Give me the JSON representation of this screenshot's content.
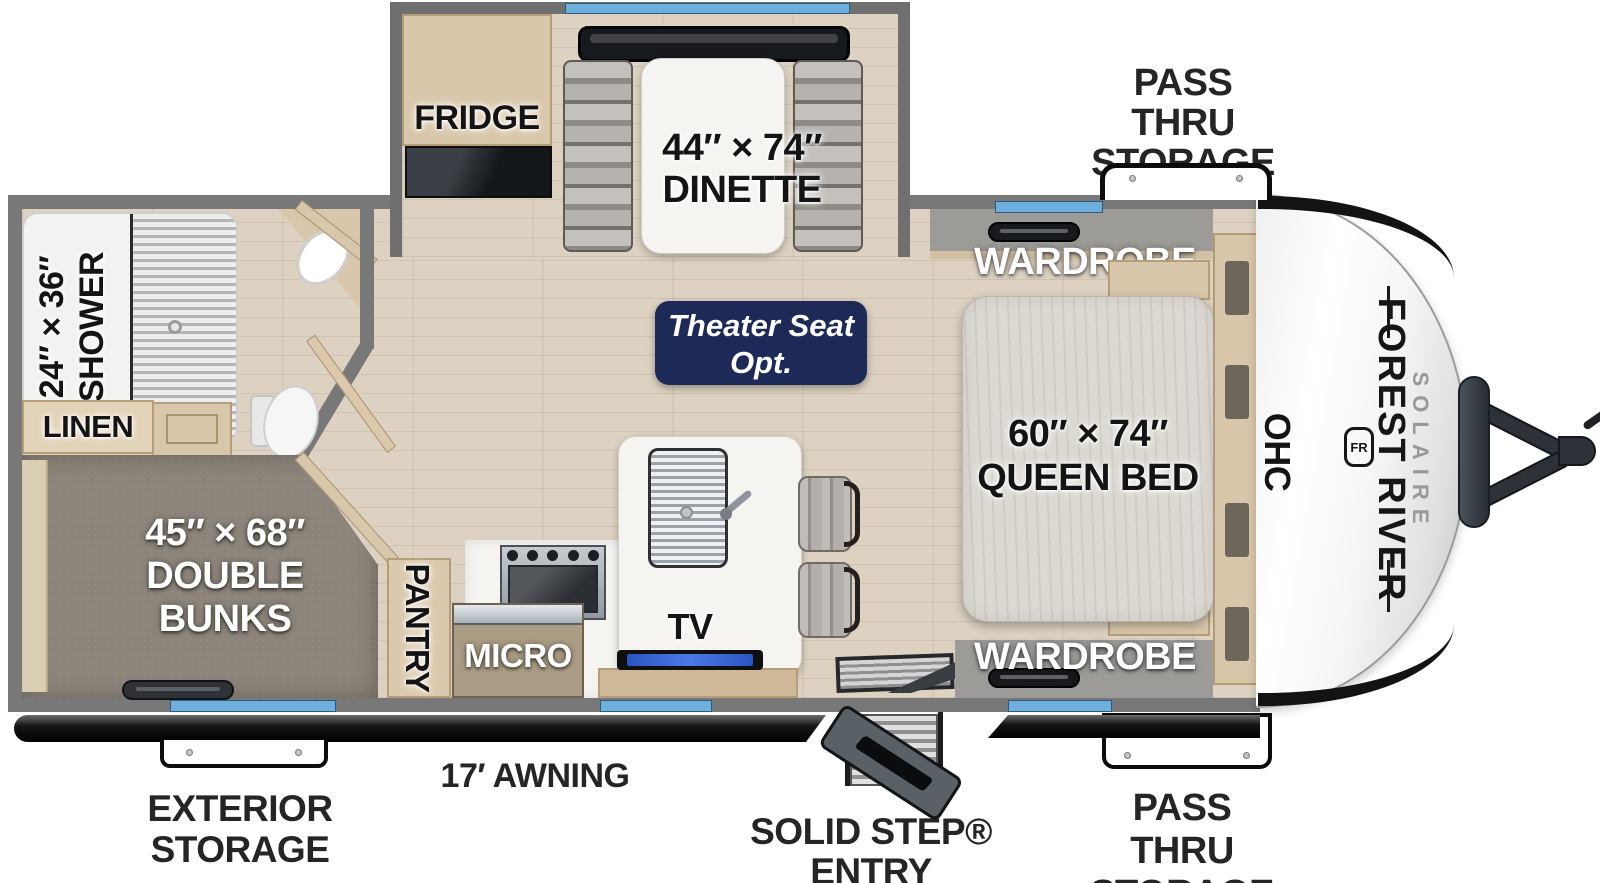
{
  "title": "Forest River Solaire travel trailer floor plan",
  "colors": {
    "wall": "#787878",
    "floor_wood": "#ddd2c2",
    "carpet": "#8d857b",
    "cabinet": "#d9c7ab",
    "counter": "#f5f4f1",
    "window": "#6fafdd",
    "badge_navy": "#1d2a57",
    "awning_black": "#111111",
    "label_dark": "#141414",
    "label_light": "#ffffff",
    "exterior_label": "#252525"
  },
  "slideout": {
    "fridge": "FRIDGE",
    "dinette_size": "44″ × 74″",
    "dinette": "DINETTE"
  },
  "bath": {
    "shower_size": "24″ × 36″",
    "shower": "SHOWER",
    "linen": "LINEN"
  },
  "bunkroom": {
    "size": "45″ × 68″",
    "line1": "DOUBLE",
    "line2": "BUNKS"
  },
  "kitchen": {
    "pantry": "PANTRY",
    "micro": "MICRO",
    "tv": "TV"
  },
  "living": {
    "badge_line1": "Theater Seat",
    "badge_line2": "Opt."
  },
  "bedroom": {
    "wardrobe_top": "WARDROBE",
    "wardrobe_bottom": "WARDROBE",
    "bed_size": "60″ × 74″",
    "bed": "QUEEN BED",
    "ohc": "OHC"
  },
  "brand": {
    "name": "FOREST RIVER",
    "model": "SOLAIRE",
    "monogram": "FR"
  },
  "exterior": {
    "front_passthru_line1": "PASS THRU",
    "front_passthru_line2": "STORAGE",
    "rear_passthru_line1": "PASS THRU",
    "rear_passthru_line2": "STORAGE",
    "storage_line1": "EXTERIOR",
    "storage_line2": "STORAGE",
    "awning": "17′ AWNING",
    "entry": "SOLID STEP® ENTRY"
  }
}
